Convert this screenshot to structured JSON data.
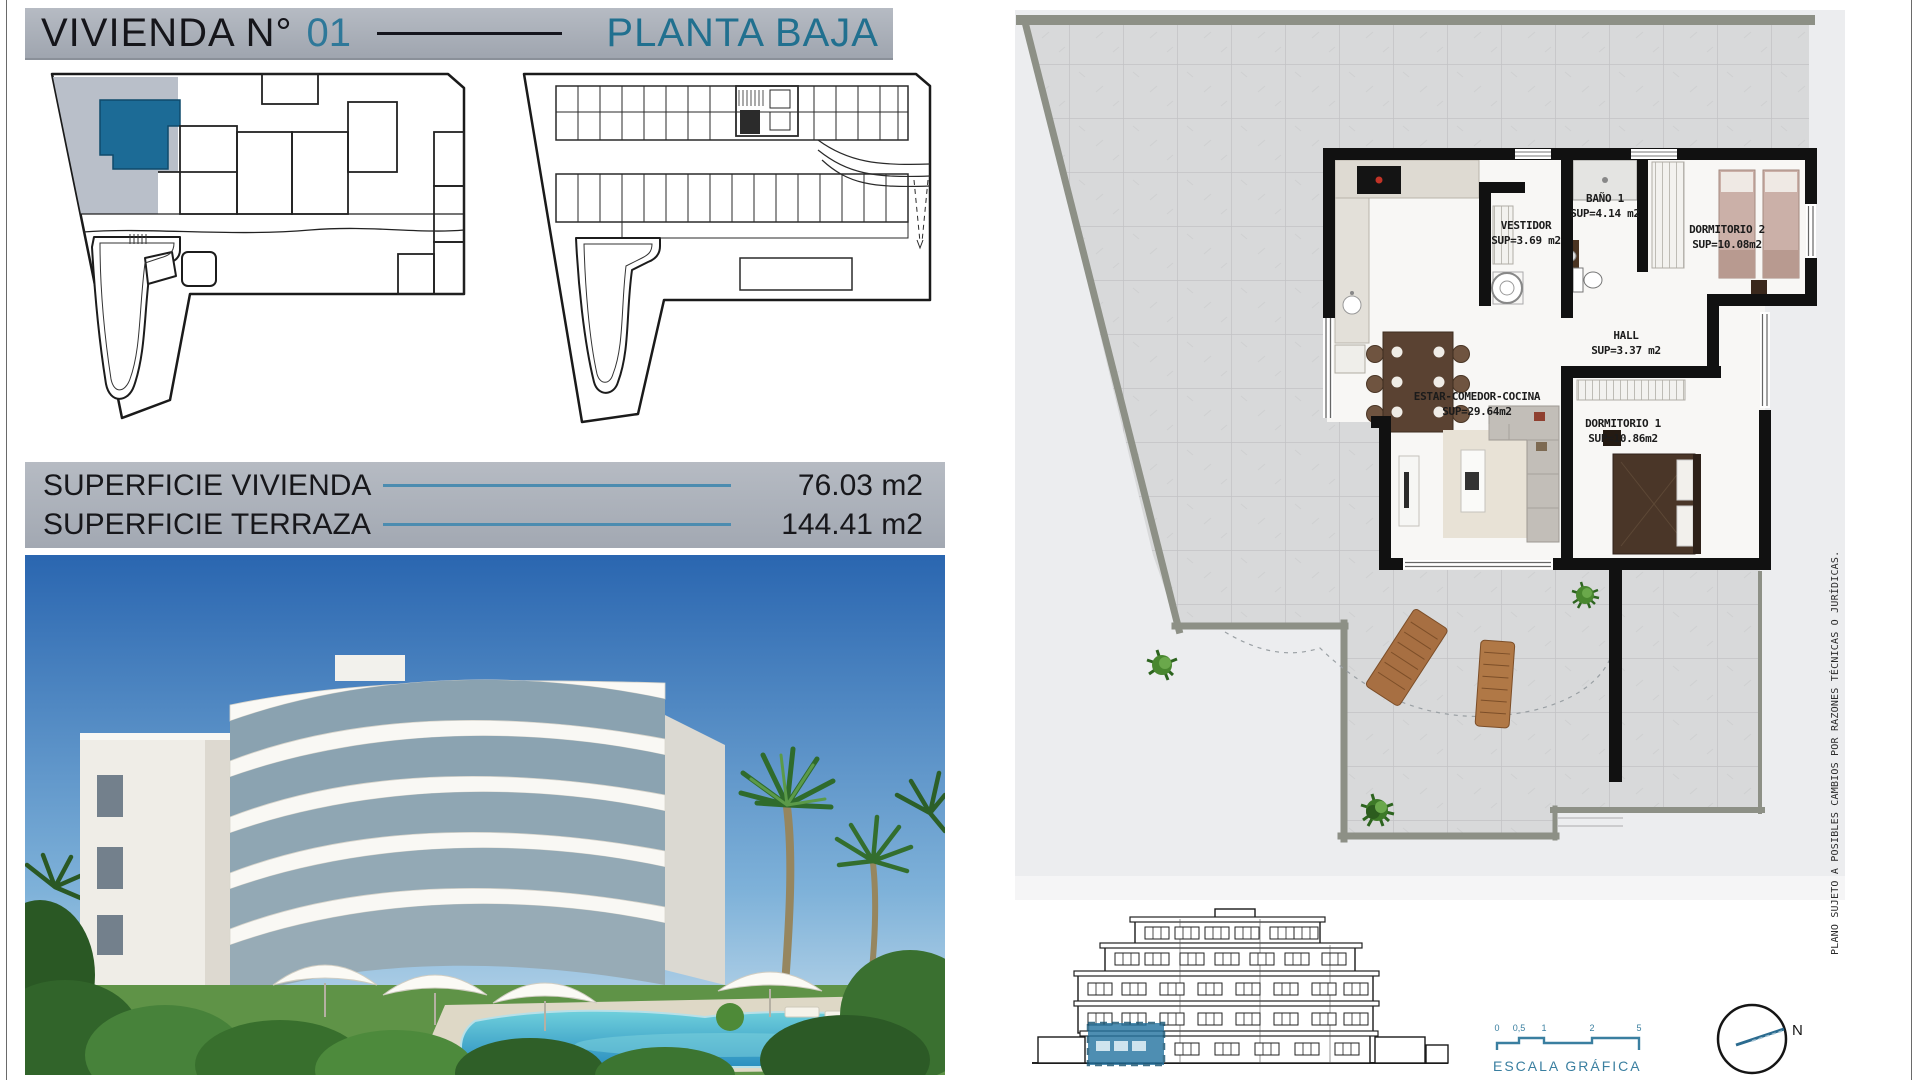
{
  "header": {
    "title": "VIVIENDA N°",
    "number": "01",
    "plan": "PLANTA BAJA"
  },
  "surfaces": {
    "rows": [
      {
        "label": "SUPERFICIE VIVIENDA",
        "value": "76.03 m2"
      },
      {
        "label": "SUPERFICIE TERRAZA",
        "value": "144.41 m2"
      }
    ]
  },
  "floor_plan": {
    "rooms": [
      {
        "name": "VESTIDOR",
        "sup": "SUP=3.69 m2"
      },
      {
        "name": "BAÑO 1",
        "sup": "SUP=4.14 m2"
      },
      {
        "name": "DORMITORIO 2",
        "sup": "SUP=10.08m2"
      },
      {
        "name": "HALL",
        "sup": "SUP=3.37 m2"
      },
      {
        "name": "ESTAR-COMEDOR-COCINA",
        "sup": "SUP=29.64m2"
      },
      {
        "name": "DORMITORIO 1",
        "sup": "SUP=10.86m2"
      }
    ]
  },
  "footer": {
    "scale_label": "ESCALA GRÁFICA",
    "scale_ticks": [
      "0",
      "0,5",
      "1",
      "2",
      "5"
    ],
    "north_label": "N"
  },
  "side_note": "PLANO SUJETO A POSIBLES CAMBIOS POR RAZONES TÉCNICAS O JURÍDICAS.",
  "colors": {
    "accent_blue": "#21708f",
    "highlight_unit_blue": "#1c6b96",
    "scale_blue": "#3a7fa0",
    "header_gray": "#a8aeb8"
  }
}
